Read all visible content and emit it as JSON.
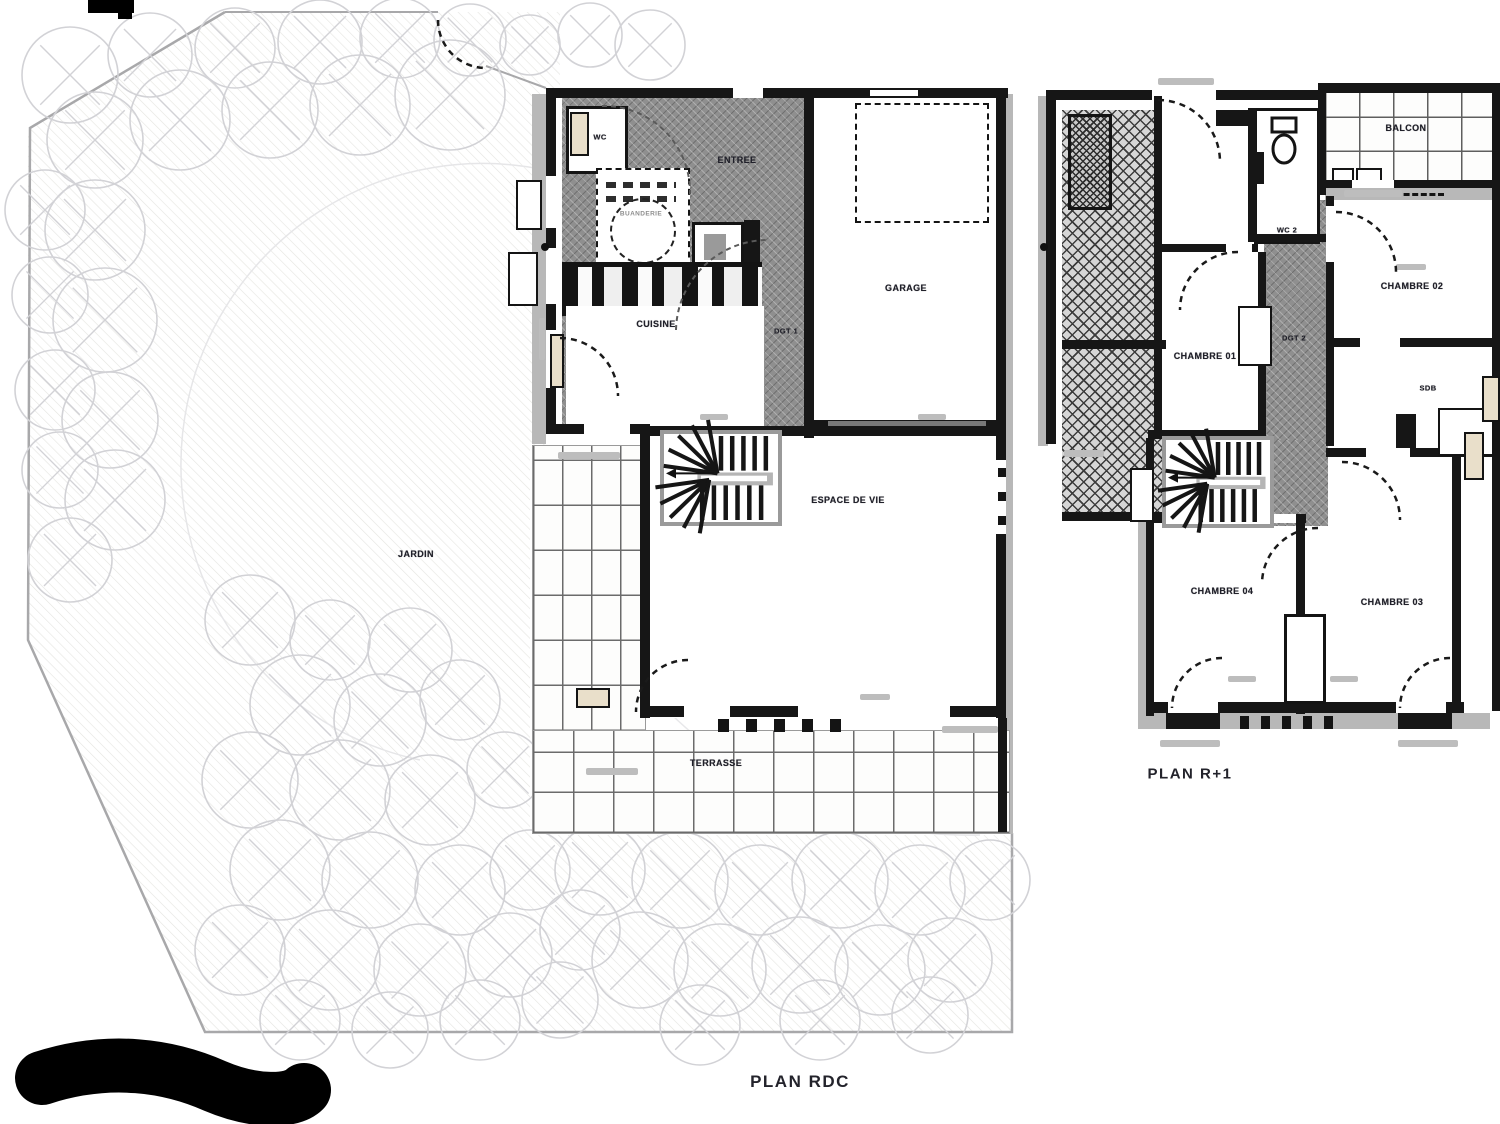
{
  "plans": {
    "rdc": {
      "title": "PLAN RDC",
      "rooms": {
        "wc": "WC",
        "entree": "ENTREE",
        "buanderie": "BUANDERIE",
        "cuisine": "CUISINE",
        "dgt1": "DGT 1",
        "garage": "GARAGE",
        "espace_de_vie": "ESPACE DE VIE",
        "terrasse": "TERRASSE",
        "jardin": "JARDIN"
      }
    },
    "r1": {
      "title": "PLAN R+1",
      "rooms": {
        "balcon": "BALCON",
        "wc2": "WC 2",
        "chambre01": "CHAMBRE 01",
        "chambre02": "CHAMBRE 02",
        "dgt2": "DGT 2",
        "sdb": "SDB",
        "chambre04": "CHAMBRE 04",
        "chambre03": "CHAMBRE 03"
      }
    }
  },
  "colors": {
    "wall": "#161616",
    "corridor_hatch": "#8f8f8f",
    "poche": "#b8b8b8",
    "tile_line": "#6b6b6b",
    "tree_stroke": "#d2d2d6",
    "redaction": "#000000"
  }
}
